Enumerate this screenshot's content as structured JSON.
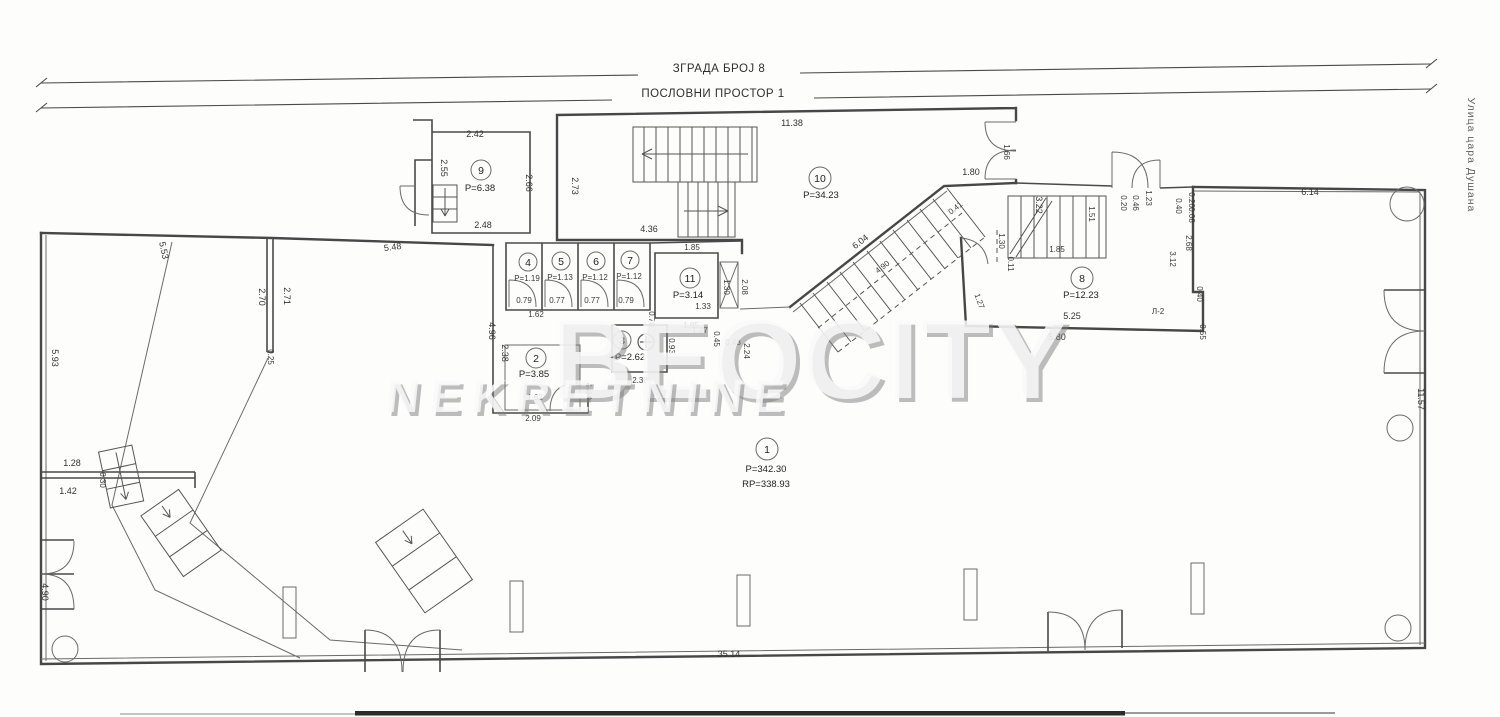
{
  "header": {
    "building_label": "ЗГРАДА БРОЈ 8",
    "space_label": "ПОСЛОВНИ ПРОСТОР 1"
  },
  "street_label": "Улица цара Душана",
  "watermark": {
    "line1": "BEOCITY",
    "line2": "NEKRETNINE"
  },
  "plan": {
    "rooms": [
      {
        "number": "1",
        "area": "P=342.30",
        "area2": "RP=338.93"
      },
      {
        "number": "2",
        "area": "P=3.85"
      },
      {
        "number": "3",
        "area": "P=2.62"
      },
      {
        "number": "4",
        "area": "P=1.19"
      },
      {
        "number": "5",
        "area": "P=1.13"
      },
      {
        "number": "6",
        "area": "P=1.12"
      },
      {
        "number": "7",
        "area": "P=1.12"
      },
      {
        "number": "8",
        "area": "P=12.23"
      },
      {
        "number": "9",
        "area": "P=6.38"
      },
      {
        "number": "10",
        "area": "P=34.23"
      },
      {
        "number": "11",
        "area": "P=3.14"
      }
    ],
    "dims": [
      "2.42",
      "2.55",
      "2.66",
      "2.48",
      "2.73",
      "11.38",
      "4.36",
      "5.48",
      "4.96",
      "5.53",
      "5.93",
      "2.70",
      "2.71",
      "0.25",
      "1.28",
      "0.30",
      "1.42",
      "4.90",
      "0.79",
      "0.77",
      "0.77",
      "0.79",
      "1.62",
      "1.85",
      "1.30",
      "2.08",
      "1.85",
      "2.38",
      "1.62",
      "2.09",
      "1.10",
      "2.38",
      "0.70",
      "0.93",
      "1.33",
      "1.27",
      "0.45",
      "0.43",
      "2.24",
      "6.04",
      "0.41",
      "4.90",
      "1.80",
      "1.66",
      "3.22",
      "1.51",
      "1.85",
      "1.30",
      "0.11",
      "1.27",
      "5.25",
      "5.80",
      "0.55",
      "0.40",
      "3.12",
      "2.68",
      "0.40",
      "0.20",
      "0.08",
      "1.23",
      "0.46",
      "0.20",
      "6.14",
      "11.57",
      "35.14"
    ],
    "annotations": {
      "l2": "Л-2"
    }
  },
  "colors": {
    "line": "#474747",
    "text": "#333333",
    "paper": "#fdfdfc",
    "watermark_shadow": "#7d7d7d"
  }
}
